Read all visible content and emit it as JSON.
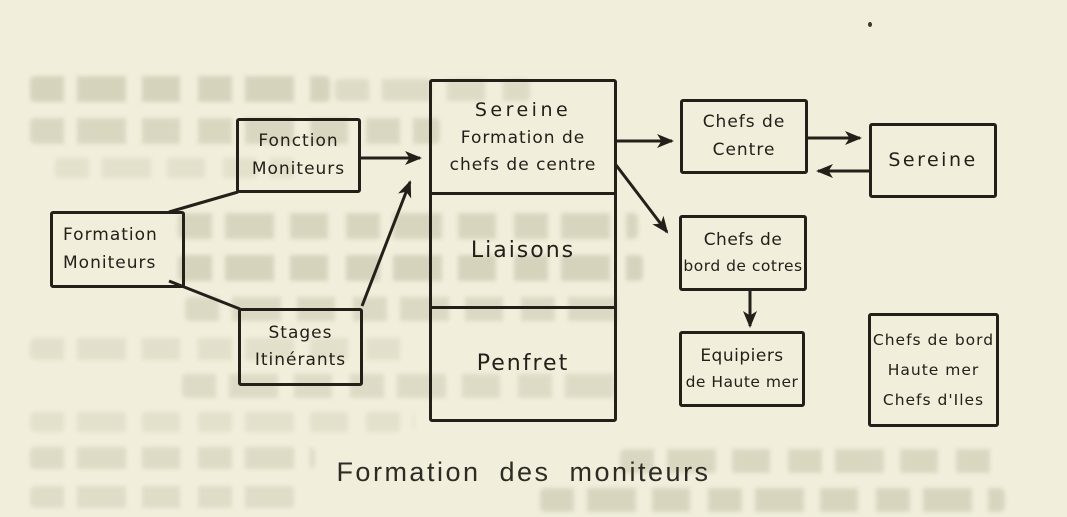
{
  "canvas": {
    "paper_color": "#f1eedc",
    "ink_color": "#23201a",
    "ghost_text_color": "#9a9877"
  },
  "caption": "Formation des moniteurs",
  "boxes": {
    "fonction_moniteurs": {
      "lines": [
        "Fonction",
        "Moniteurs"
      ]
    },
    "formation_moniteurs": {
      "lines": [
        "Formation",
        "Moniteurs"
      ]
    },
    "stages_itinerants": {
      "lines": [
        "Stages",
        "Itinérants"
      ]
    },
    "central": {
      "sections": [
        {
          "lines": [
            "Sereine",
            "Formation de",
            "chefs de centre"
          ]
        },
        {
          "lines": [
            "Liaisons"
          ]
        },
        {
          "lines": [
            "Penfret"
          ]
        }
      ]
    },
    "chefs_de_centre": {
      "lines": [
        "Chefs de",
        "Centre"
      ]
    },
    "sereine": {
      "lines": [
        "Sereine"
      ]
    },
    "chefs_de_bord_de_cotres": {
      "lines": [
        "Chefs de",
        "bord de cotres"
      ]
    },
    "equipiers_de_haute_mer": {
      "lines": [
        "Equipiers",
        "de Haute mer"
      ]
    },
    "chefs_de_bord_haute_mer": {
      "lines": [
        "Chefs de bord",
        "Haute mer",
        "Chefs d'Iles"
      ]
    }
  },
  "edges": [
    {
      "from": "Formation Moniteurs",
      "to": "Fonction Moniteurs",
      "type": "line"
    },
    {
      "from": "Formation Moniteurs",
      "to": "Stages Itinérants",
      "type": "line"
    },
    {
      "from": "Fonction Moniteurs",
      "to": "Sereine Formation de chefs de centre",
      "type": "arrow"
    },
    {
      "from": "Stages Itinérants",
      "to": "Sereine Formation de chefs de centre",
      "type": "arrow"
    },
    {
      "from": "Sereine Formation de chefs de centre",
      "to": "Chefs de Centre",
      "type": "arrow"
    },
    {
      "from": "Sereine Formation de chefs de centre",
      "to": "Chefs de bord de cotres",
      "type": "arrow"
    },
    {
      "from": "Chefs de Centre",
      "to": "Sereine",
      "type": "arrow"
    },
    {
      "from": "Sereine",
      "to": "Chefs de Centre",
      "type": "arrow"
    },
    {
      "from": "Chefs de bord de cotres",
      "to": "Equipiers de Haute mer",
      "type": "arrow"
    }
  ]
}
